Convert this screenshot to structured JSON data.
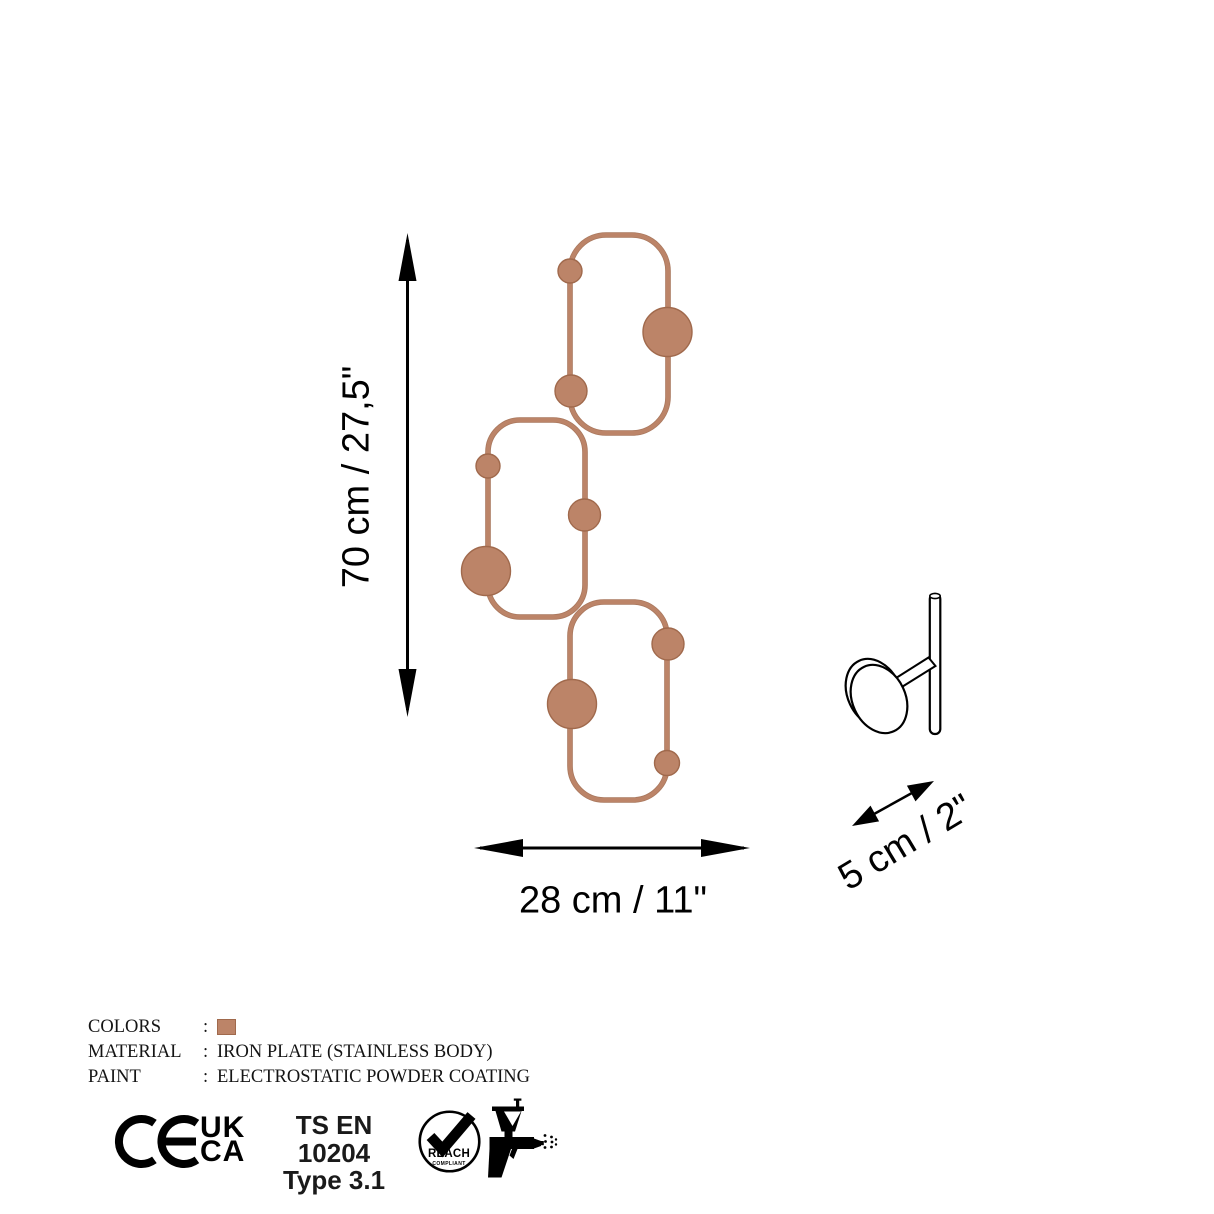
{
  "colors": {
    "copper": "#bc8468",
    "copper-dark": "#a0694c"
  },
  "dimensions": {
    "height": "70 cm / 27,5\"",
    "width": "28 cm / 11\"",
    "depth": "5 cm / 2\""
  },
  "specs": {
    "rows": [
      {
        "label": "COLORS",
        "colon": ":",
        "value": ""
      },
      {
        "label": "MATERIAL",
        "colon": ":",
        "value": "IRON PLATE (STAINLESS BODY)"
      },
      {
        "label": "PAINT",
        "colon": ":",
        "value": "ELECTROSTATIC POWDER COATING"
      }
    ]
  },
  "certifications": {
    "ce": "CE",
    "ukca": {
      "line1": "UK",
      "line2": "CA"
    },
    "standard": {
      "line1": "TS EN 10204",
      "line2": "Type 3.1"
    },
    "reach": {
      "label": "REACH",
      "sub": "COMPLIANT"
    }
  }
}
